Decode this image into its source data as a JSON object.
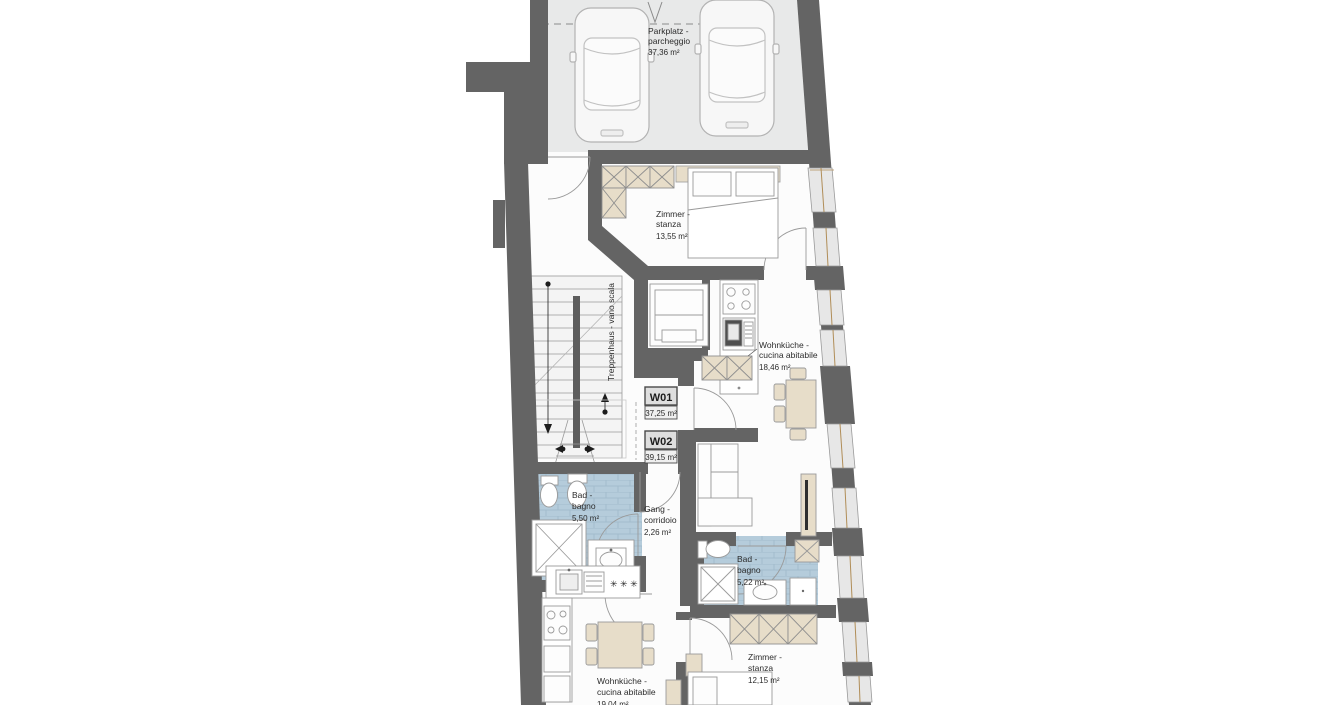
{
  "plan": {
    "type": "architectural-floor-plan",
    "colors": {
      "wall": "#646464",
      "parking_floor": "#e8e9e9",
      "bathroom_tile": "#b5ccdb",
      "furniture_beige": "#e7ddc9",
      "floor": "#fcfcfc",
      "drawing_line": "#9a9a9a"
    },
    "rooms": {
      "parkplatz": {
        "name_de": "Parkplatz -",
        "name_it": "parcheggio",
        "area": "37,36 m²"
      },
      "zimmer_w01": {
        "name_de": "Zimmer -",
        "name_it": "stanza",
        "area": "13,55 m²"
      },
      "treppenhaus": {
        "label": "Treppenhaus - vano scala"
      },
      "wohnkueche_w01": {
        "name_de": "Wohnküche -",
        "name_it": "cucina abitabile",
        "area": "18,46 m²"
      },
      "bad_w01": {
        "name_de": "Bad -",
        "name_it": "bagno",
        "area": "5,50 m²"
      },
      "gang": {
        "name_de": "Gang -",
        "name_it": "corridoio",
        "area": "2,26 m²"
      },
      "bad_w02": {
        "name_de": "Bad -",
        "name_it": "bagno",
        "area": "5,22 m²"
      },
      "zimmer_w02": {
        "name_de": "Zimmer -",
        "name_it": "stanza",
        "area": "12,15 m²"
      },
      "wohnkueche_w02": {
        "name_de": "Wohnküche -",
        "name_it": "cucina abitabile",
        "area": "19,04 m²"
      }
    },
    "units": {
      "w01": {
        "label": "W01",
        "area": "37,25 m²"
      },
      "w02": {
        "label": "W02",
        "area": "39,15 m²"
      }
    }
  }
}
